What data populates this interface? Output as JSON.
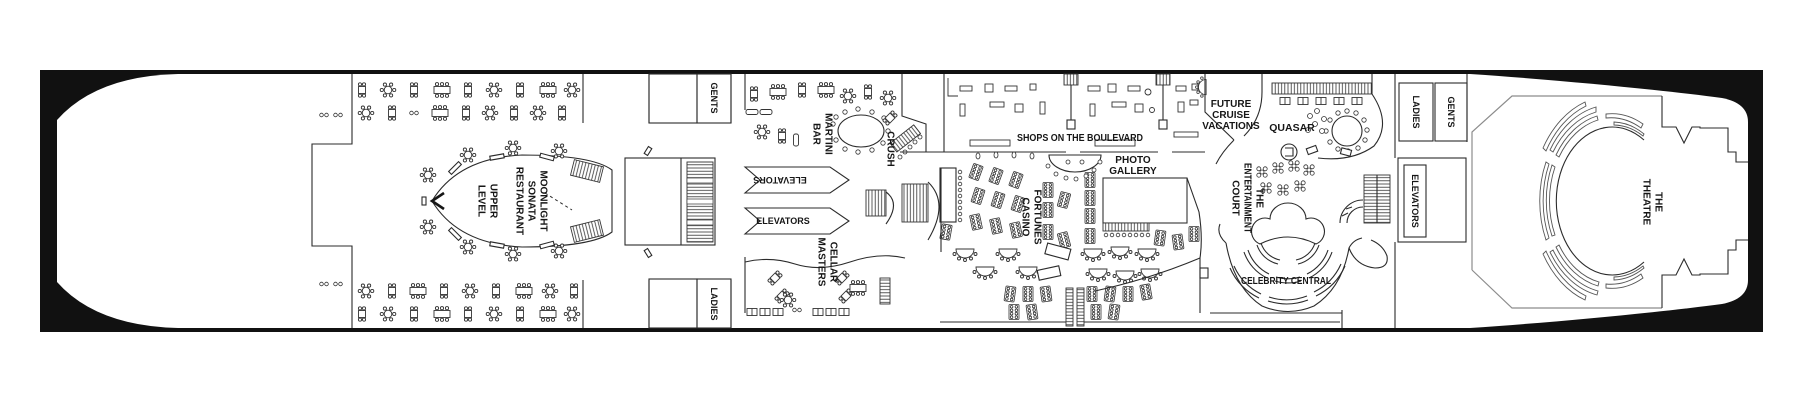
{
  "title": "Cruise ship deck plan",
  "colors": {
    "paper": "#ffffff",
    "hull": "#111111",
    "ink": "#2b2b2b",
    "wall_gray": "#8c8c8c"
  },
  "labels": {
    "restaurant": [
      "MOONLIGHT",
      "SONATA",
      "RESTAURANT"
    ],
    "upper_level": [
      "UPPER",
      "LEVEL"
    ],
    "gents_fwd": "GENTS",
    "ladies_fwd": "LADIES",
    "martini_bar": [
      "MARTINI",
      "BAR"
    ],
    "crush": "CRUSH",
    "elevators_mid_upper": "ELEVATORS",
    "elevators_mid_lower": "ELEVATORS",
    "cellar_masters": [
      "CELLAR",
      "MASTERS"
    ],
    "shops": "SHOPS ON THE BOULEVARD",
    "casino": [
      "FORTUNES",
      "CASINO"
    ],
    "photo_gallery": [
      "PHOTO",
      "GALLERY"
    ],
    "future_cruise": [
      "FUTURE",
      "CRUISE",
      "VACATIONS"
    ],
    "quasar": "QUASAR",
    "entertainment_court": [
      "THE",
      "ENTERTAINMENT",
      "COURT"
    ],
    "celebrity_central": "CELEBRITY CENTRAL",
    "elevators_aft": "ELEVATORS",
    "ladies_aft": "LADIES",
    "gents_aft": "GENTS",
    "theatre": [
      "THE",
      "THEATRE"
    ]
  }
}
